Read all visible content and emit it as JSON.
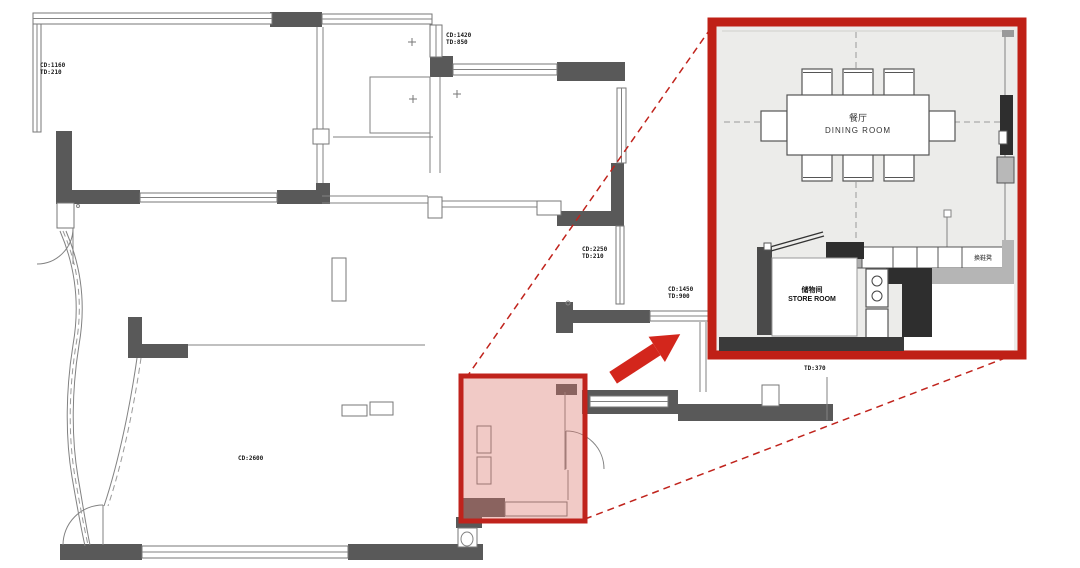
{
  "plan": {
    "annotations": [
      {
        "line1": "CD:1160",
        "line2": "TD:210"
      },
      {
        "line1": "CD:1420",
        "line2": "TD:850"
      },
      {
        "line1": "CD:2250",
        "line2": "TD:210"
      },
      {
        "line1": "CD:1450",
        "line2": "TD:900"
      },
      {
        "line1": "TD:370",
        "line2": ""
      },
      {
        "line1": "CD:2600",
        "line2": ""
      }
    ]
  },
  "inset": {
    "dining_room": {
      "label_cn": "餐厅",
      "label_en": "DINING ROOM"
    },
    "store_room": {
      "label_cn": "储物间",
      "label_en": "STORE ROOM"
    },
    "bench_label": "换鞋凳"
  },
  "colors": {
    "callout_red": "#c0231c",
    "arrow_red": "#d3261c",
    "highlight_fill": "rgba(219,116,104,0.38)",
    "wall_dark": "#595959",
    "inset_bg": "#ececea"
  }
}
